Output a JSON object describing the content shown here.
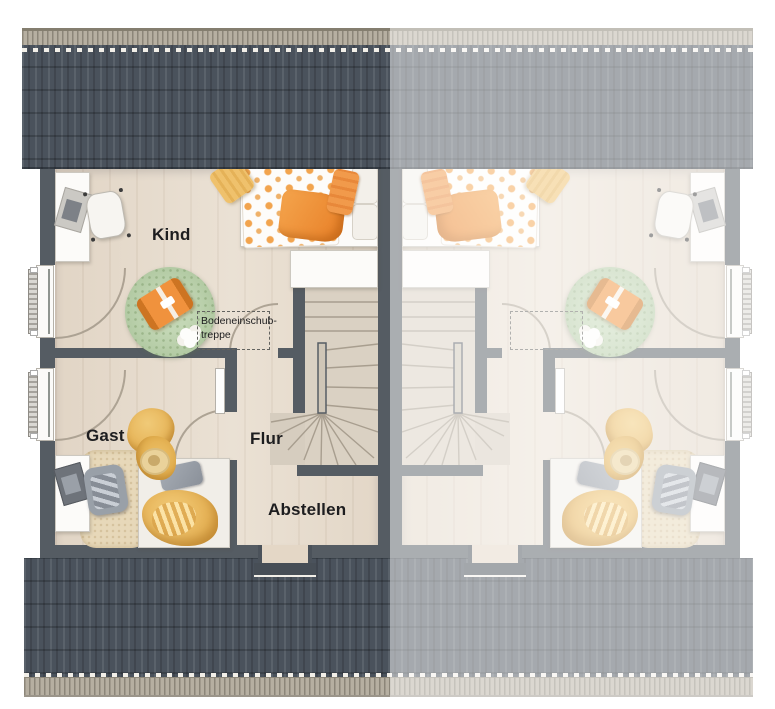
{
  "plan": {
    "type": "floor-plan-top-view",
    "rooms": {
      "kind": {
        "label": "Kind"
      },
      "gast": {
        "label": "Gast"
      },
      "flur": {
        "label": "Flur"
      },
      "abstellen": {
        "label": "Abstellen"
      }
    },
    "annotations": {
      "bodeneinschubtreppe": {
        "label": "Bodeneinschub-\ntreppe"
      }
    },
    "units": {
      "left": "active",
      "right": "mirrored-faded"
    },
    "colors": {
      "roof_dark": "#4a525c",
      "roof_trim": "#b6afa1",
      "wall": "#555c63",
      "floor_wood": "#e7dccd",
      "stair_wood": "#dad1c3",
      "rug_green": "#b8cfa9",
      "accent_orange": "#f0923d",
      "accent_yellow": "#e8bc63",
      "furniture_white": "#fcfbf9",
      "label_text": "#1d1d1f",
      "fade_overlay": "rgba(255,255,255,0.5)"
    }
  }
}
